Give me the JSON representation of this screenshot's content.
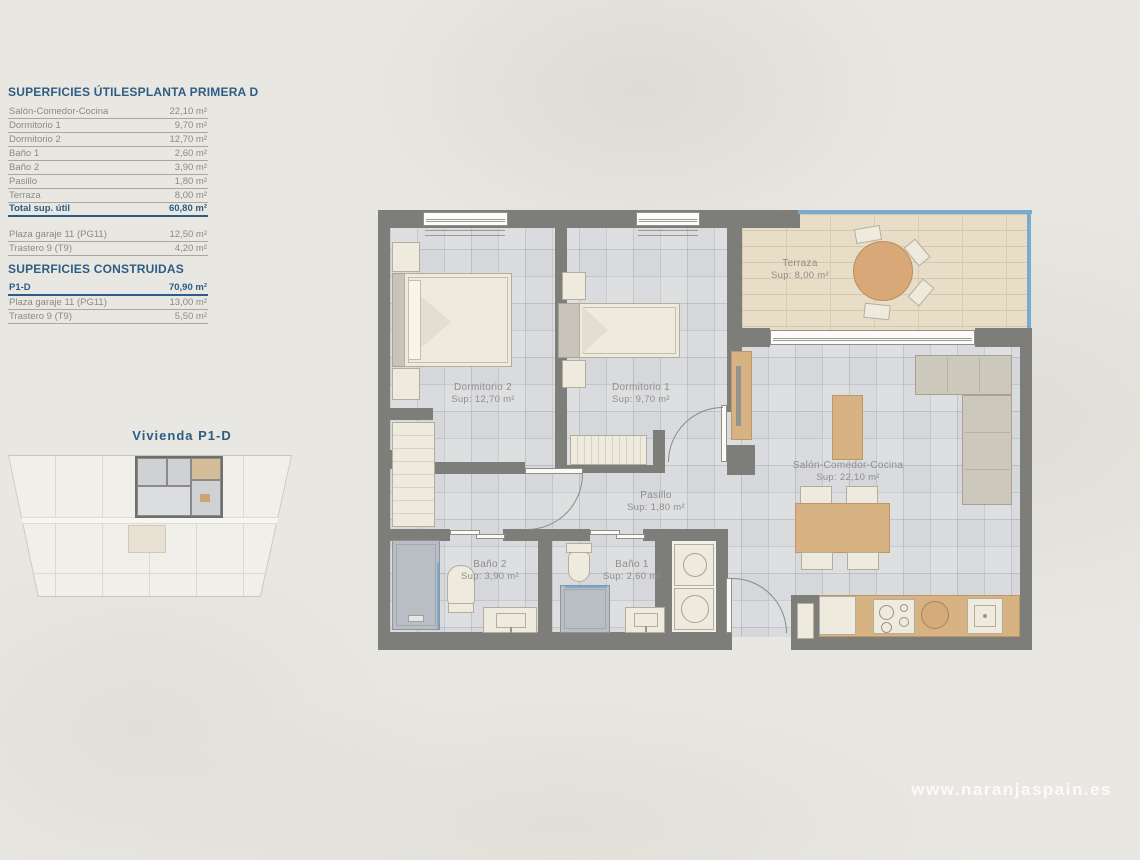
{
  "page": {
    "watermark": "www.naranjaspain.es"
  },
  "superficies_utiles": {
    "title": "SUPERFICIES ÚTILES",
    "plan_name": "PLANTA PRIMERA D",
    "rows": [
      {
        "label": "Salón-Comedor-Cocina",
        "value": "22,10 m²"
      },
      {
        "label": "Dormitorio 1",
        "value": "9,70 m²"
      },
      {
        "label": "Dormitorio 2",
        "value": "12,70 m²"
      },
      {
        "label": "Baño 1",
        "value": "2,60 m²"
      },
      {
        "label": "Baño 2",
        "value": "3,90 m²"
      },
      {
        "label": "Pasillo",
        "value": "1,80 m²"
      },
      {
        "label": "Terraza",
        "value": "8,00 m²"
      }
    ],
    "total": {
      "label": "Total sup. útil",
      "value": "60,80 m²"
    },
    "annex_rows": [
      {
        "label": "Plaza garaje 11 (PG11)",
        "value": "12,50 m²"
      },
      {
        "label": "Trastero 9 (T9)",
        "value": "4,20 m²"
      }
    ]
  },
  "superficies_construidas": {
    "title": "SUPERFICIES CONSTRUIDAS",
    "rows": [
      {
        "label": "P1-D",
        "value": "70,90 m²"
      },
      {
        "label": "Plaza garaje 11 (PG11)",
        "value": "13,00 m²"
      },
      {
        "label": "Trastero 9 (T9)",
        "value": "5,50 m²"
      }
    ]
  },
  "key_plan": {
    "title": "Vivienda P1-D"
  },
  "floor_plan": {
    "rooms": [
      {
        "name": "Terraza",
        "sup": "Sup: 8,00 m²"
      },
      {
        "name": "Dormitorio 2",
        "sup": "Sup: 12,70 m²"
      },
      {
        "name": "Dormitorio 1",
        "sup": "Sup: 9,70 m²"
      },
      {
        "name": "Pasillo",
        "sup": "Sup: 1,80 m²"
      },
      {
        "name": "Baño 2",
        "sup": "Sup: 3,90 m²"
      },
      {
        "name": "Baño 1",
        "sup": "Sup: 2,60 m²"
      },
      {
        "name": "Salón-Comedor-Cocina",
        "sup": "Sup: 22,10 m²"
      }
    ]
  },
  "colors": {
    "accent_blue": "#2d5c84",
    "wall_gray": "#7d7d7a",
    "railing_blue": "#79aacf",
    "terrace_tan": "#e8dec8",
    "wood": "#d7b383"
  }
}
